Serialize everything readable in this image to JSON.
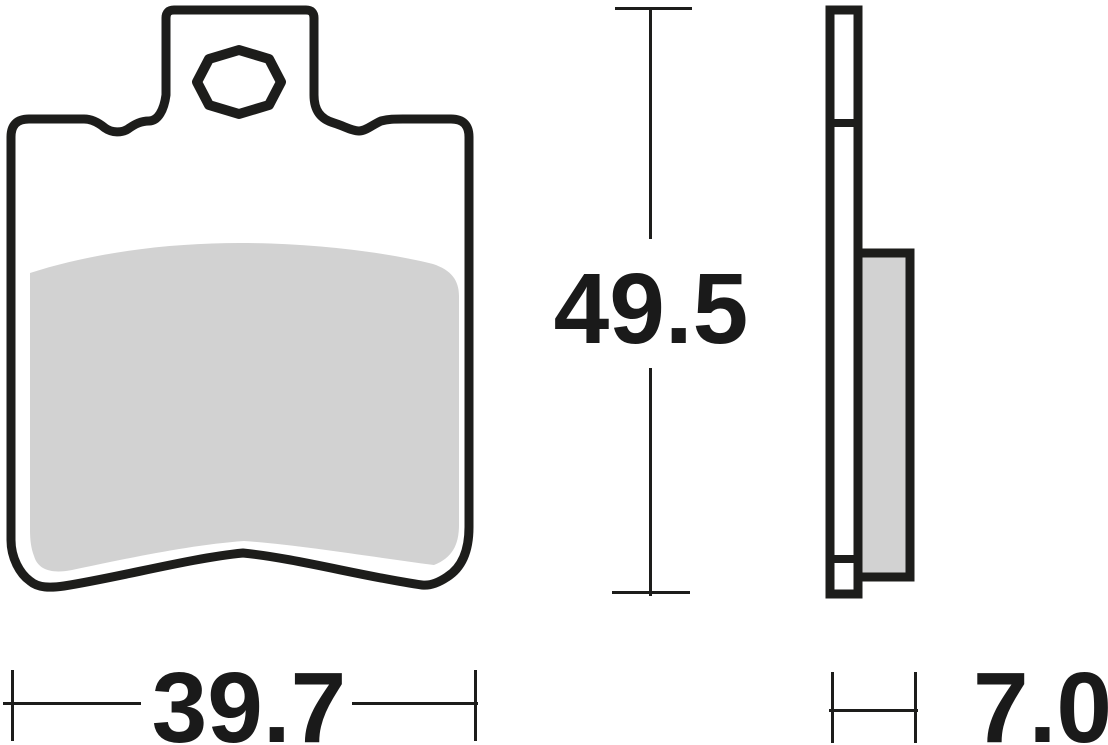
{
  "drawing": {
    "kind": "technical-drawing",
    "subject": "brake-pad-two-view"
  },
  "dimensions": {
    "height": "49.5",
    "width": "39.7",
    "thickness": "7.0"
  },
  "colors": {
    "line": "#1d1d1b",
    "friction": "#d2d2d2",
    "background": "#ffffff",
    "text": "#1a1a1a"
  }
}
